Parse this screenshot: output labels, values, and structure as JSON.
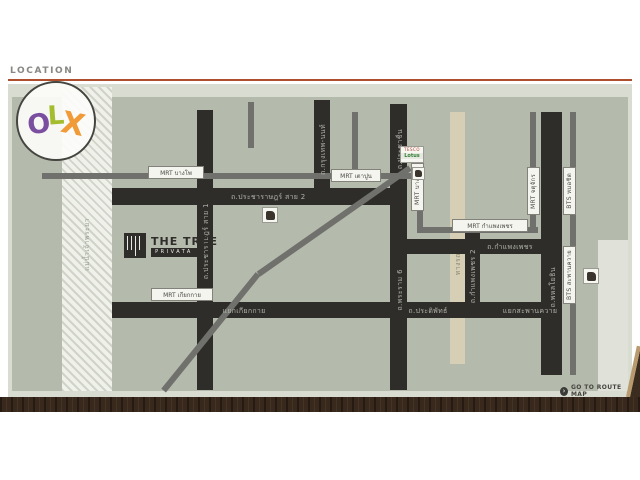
{
  "header": {
    "title": "LOCATION"
  },
  "watermark": {
    "letters": [
      "O",
      "L",
      "X"
    ]
  },
  "project": {
    "name": "THE TREE",
    "sub": "PRIVATA"
  },
  "footer": {
    "route_link": "GO TO ROUTE MAP",
    "route_icon": "›"
  },
  "map": {
    "colors": {
      "field": "#b4bbac",
      "road": "#2e2d29",
      "transit_line": "#70706c",
      "railway": "#d6cfb5",
      "accent_rule": "#ad4f2c"
    },
    "stations": [
      {
        "label": "MRT บางโพ"
      },
      {
        "label": "MRT เตาปูน"
      },
      {
        "label": "MRT บางซื่อ"
      },
      {
        "label": "MRT กำแพงเพชร"
      },
      {
        "label": "MRT จตุจักร"
      },
      {
        "label": "BTS หมอชิต"
      },
      {
        "label": "BTS สะพานควาย"
      },
      {
        "label": "MRT เกียกกาย"
      }
    ],
    "roads": {
      "pracharat2": "ถ.ประชาราษฎร์ สาย 2",
      "pracharat1": "ถ.ประชาราษฎร์ สาย 1",
      "krungthep_non": "ถ.กรุงเทพ-นนท์",
      "prachachuen": "ถ.ประชาชื่น",
      "rama6": "ถ.พระราม 6",
      "kamphaengphet_road": "ถ.กำแพงเพชร",
      "kamphaengphet2": "ถ.กำแพงเพชร 2",
      "phahonyothin": "ถ.พหลโยธิน",
      "pradipat": "ถ.ประดิพัทธ์",
      "kiakkai_junction": "แยกเกียกกาย",
      "saphankhwai_junction": "แยกสะพานควาย",
      "railway": "ทางรถไฟ",
      "river": "แม่น้ำเจ้าพระยา"
    },
    "pois": {
      "tesco_line1": "TESCO",
      "tesco_line2": "Lotus"
    }
  }
}
